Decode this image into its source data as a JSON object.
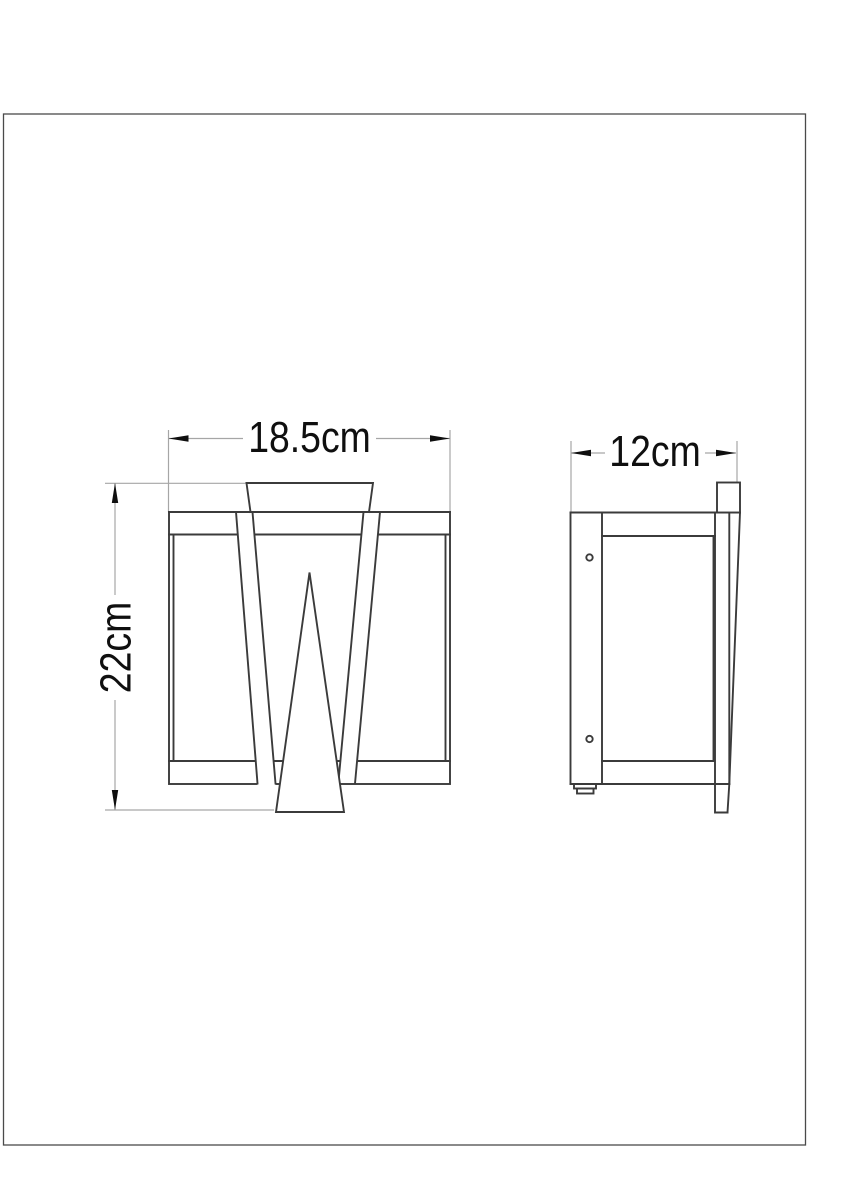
{
  "page": {
    "background": "#ffffff",
    "border_color": "#4a4a4a"
  },
  "drawing": {
    "front_view": {
      "width_dimension": {
        "label": "18.5cm",
        "value_cm": 18.5
      },
      "height_dimension": {
        "label": "22cm",
        "value_cm": 22
      }
    },
    "side_view": {
      "depth_dimension": {
        "label": "12cm",
        "value_cm": 12
      }
    },
    "colors": {
      "object_line": "#3b3b3b",
      "dimension_line": "#a6a6a6",
      "dimension_text": "#0f0f0f"
    }
  }
}
